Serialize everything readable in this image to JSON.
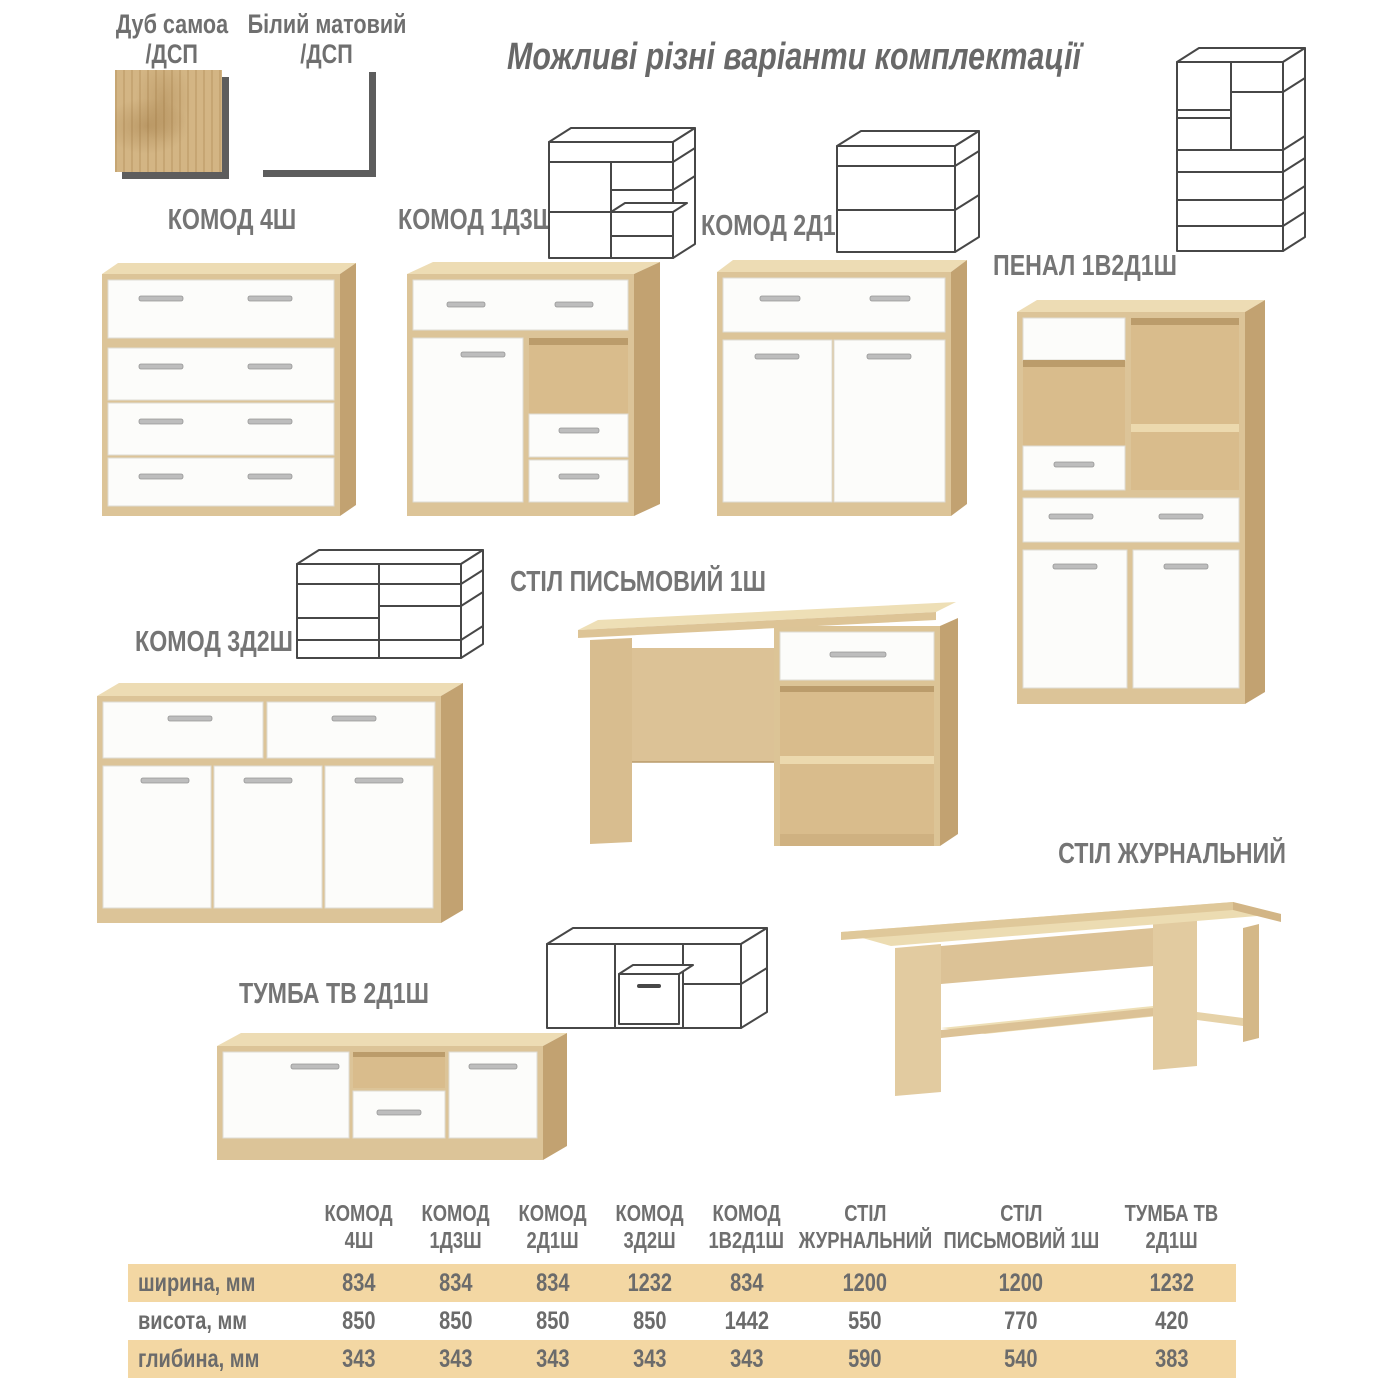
{
  "page": {
    "title": "Можливі різні варіанти комплектації"
  },
  "legend": {
    "oak": {
      "line1": "Дуб самоа",
      "line2": "/ДСП"
    },
    "white": {
      "line1": "Білий матовий",
      "line2": "/ДСП"
    }
  },
  "products": [
    {
      "name": "КОМОД 4Ш"
    },
    {
      "name": "КОМОД 1Д3Ш"
    },
    {
      "name": "КОМОД 2Д1Ш"
    },
    {
      "name": "ПЕНАЛ 1В2Д1Ш"
    },
    {
      "name": "КОМОД 3Д2Ш"
    },
    {
      "name": "СТІЛ ПИСЬМОВИЙ 1Ш"
    },
    {
      "name": "СТІЛ ЖУРНАЛЬНИЙ"
    },
    {
      "name": "ТУМБА ТВ 2Д1Ш"
    }
  ],
  "spec_table": {
    "columns": [
      {
        "line1": "КОМОД",
        "line2": "4Ш"
      },
      {
        "line1": "КОМОД",
        "line2": "1Д3Ш"
      },
      {
        "line1": "КОМОД",
        "line2": "2Д1Ш"
      },
      {
        "line1": "КОМОД",
        "line2": "3Д2Ш"
      },
      {
        "line1": "КОМОД",
        "line2": "1В2Д1Ш"
      },
      {
        "line1": "СТІЛ",
        "line2": "ЖУРНАЛЬНИЙ"
      },
      {
        "line1": "СТІЛ",
        "line2": "ПИСЬМОВИЙ 1Ш"
      },
      {
        "line1": "ТУМБА ТВ",
        "line2": "2Д1Ш"
      }
    ],
    "rows": [
      {
        "label": "ширина, мм",
        "highlight": true,
        "values": [
          "834",
          "834",
          "834",
          "1232",
          "834",
          "1200",
          "1200",
          "1232"
        ]
      },
      {
        "label": "висота, мм",
        "highlight": false,
        "values": [
          "850",
          "850",
          "850",
          "850",
          "1442",
          "550",
          "770",
          "420"
        ]
      },
      {
        "label": "глибина, мм",
        "highlight": true,
        "values": [
          "343",
          "343",
          "343",
          "343",
          "343",
          "590",
          "540",
          "383"
        ]
      }
    ]
  },
  "colors": {
    "band": "#f3d7a3",
    "oak_front": "#dcc498",
    "oak_top": "#eddcb4",
    "oak_side": "#c2a271",
    "white_front": "#fcfcfa",
    "text_gray": "#6f6f6f"
  }
}
